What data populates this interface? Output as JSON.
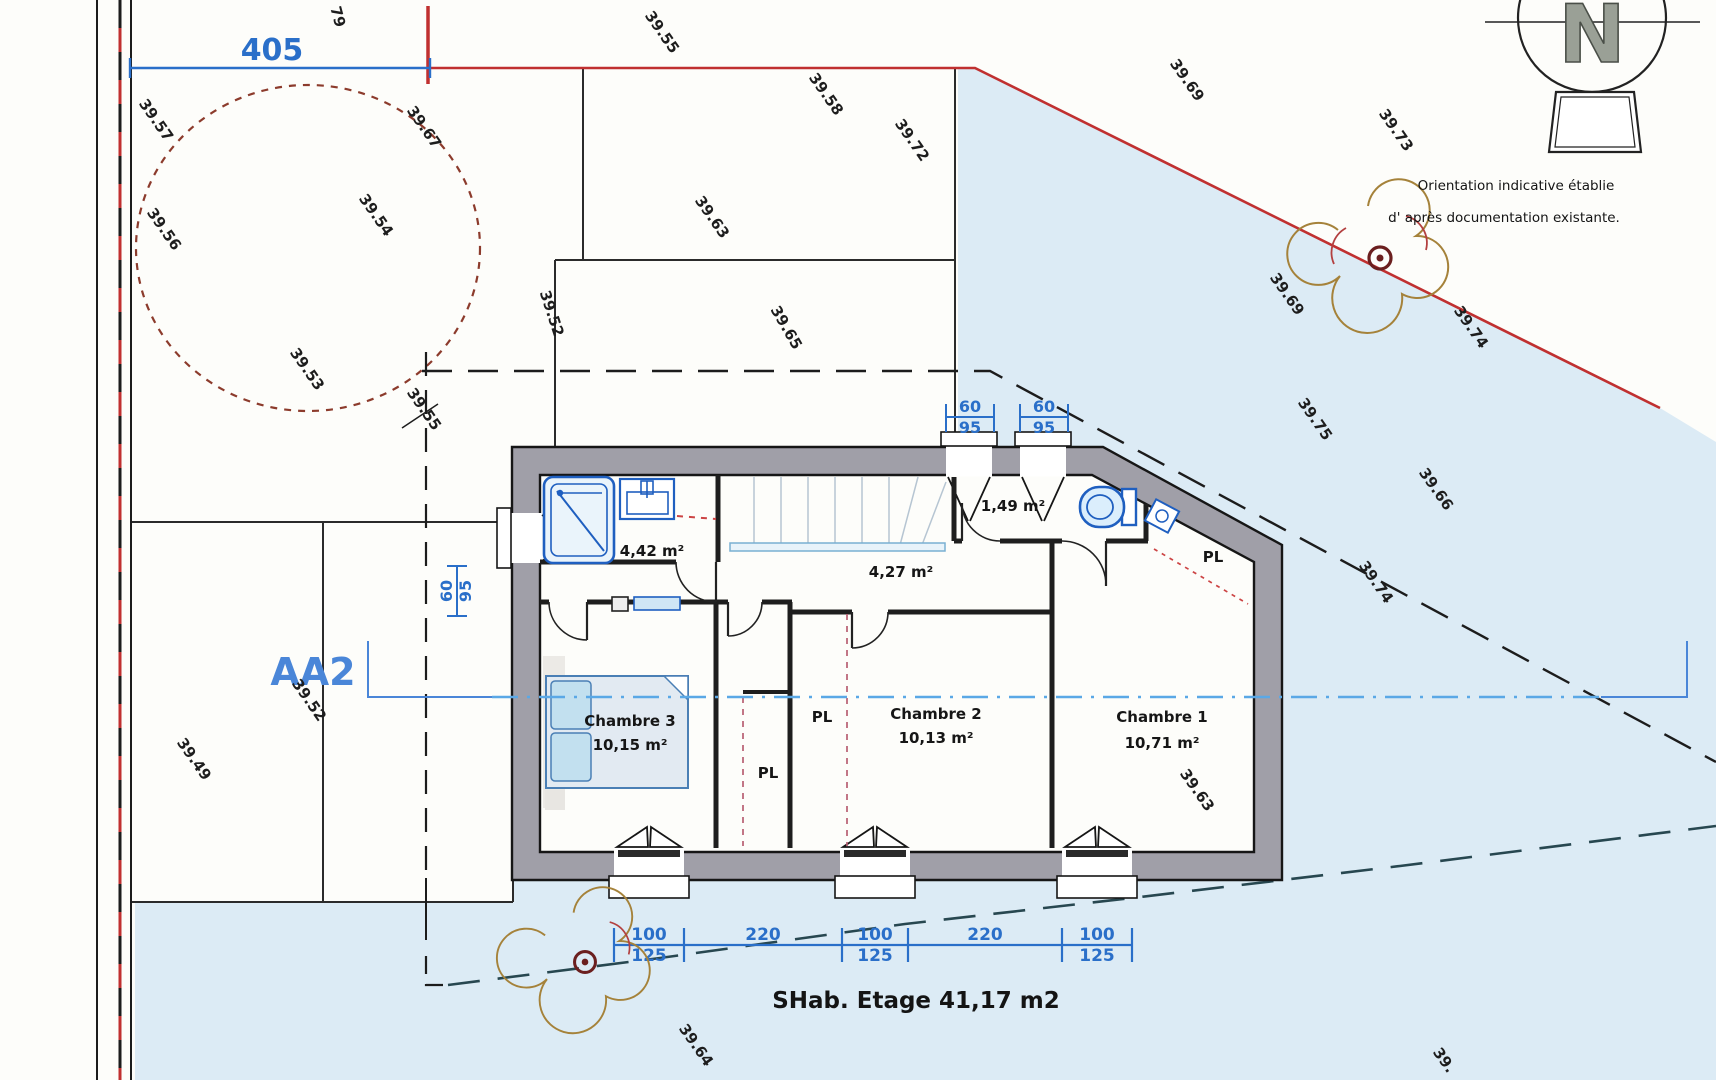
{
  "meta": {
    "kind": "architectural-floor-plan",
    "floor": "Etage"
  },
  "colors": {
    "terrain_blue": "#dcebf5",
    "wall_gray": "#a09fa8",
    "boundary_red": "#c03030",
    "dimension_blue": "#2a6fc9",
    "section_blue": "#4a86d8",
    "section_line_blue": "#5aa8e6",
    "fixture_blue": "#1f5fc0",
    "circle_brown": "#8c3b2c",
    "closet_dash_red": "#b85f72",
    "site_dash_dark": "#274750",
    "north_gray": "#8f958c"
  },
  "north": {
    "letter": "N",
    "caption1": "Orientation indicative établie",
    "caption2": "d' après documentation existante."
  },
  "section_label": "AA2",
  "dimensions": {
    "top_boundary": "405",
    "boundary_note": "79",
    "window_top_1": {
      "width": "60",
      "height": "95"
    },
    "window_top_2": {
      "width": "60",
      "height": "95"
    },
    "window_left": {
      "width": "60",
      "height": "95"
    },
    "chain": [
      {
        "top": "100",
        "bottom": "125"
      },
      {
        "top": "220"
      },
      {
        "top": "100",
        "bottom": "125"
      },
      {
        "top": "220"
      },
      {
        "top": "100",
        "bottom": "125"
      }
    ]
  },
  "rooms": {
    "bathroom": {
      "area": "4,42 m²"
    },
    "hall": {
      "area": "4,27 m²"
    },
    "wc": {
      "area": "1,49 m²"
    },
    "bedroom3": {
      "name": "Chambre 3",
      "area": "10,15 m²"
    },
    "bedroom2": {
      "name": "Chambre 2",
      "area": "10,13 m²"
    },
    "bedroom1": {
      "name": "Chambre 1",
      "area": "10,71 m²"
    }
  },
  "closets": [
    {
      "label": "PL"
    },
    {
      "label": "PL"
    },
    {
      "label": "PL"
    }
  ],
  "summary": "SHab. Etage 41,17 m2",
  "elevations": [
    "39.57",
    "39.56",
    "39.67",
    "39.54",
    "39.53",
    "39.55",
    "39.55",
    "39.58",
    "39.72",
    "39.63",
    "39.65",
    "39.52",
    "39.69",
    "39.73",
    "39.69",
    "39.74",
    "39.75",
    "39.66",
    "39.74",
    "39.63",
    "39.52",
    "39.49",
    "39.64",
    "39."
  ]
}
